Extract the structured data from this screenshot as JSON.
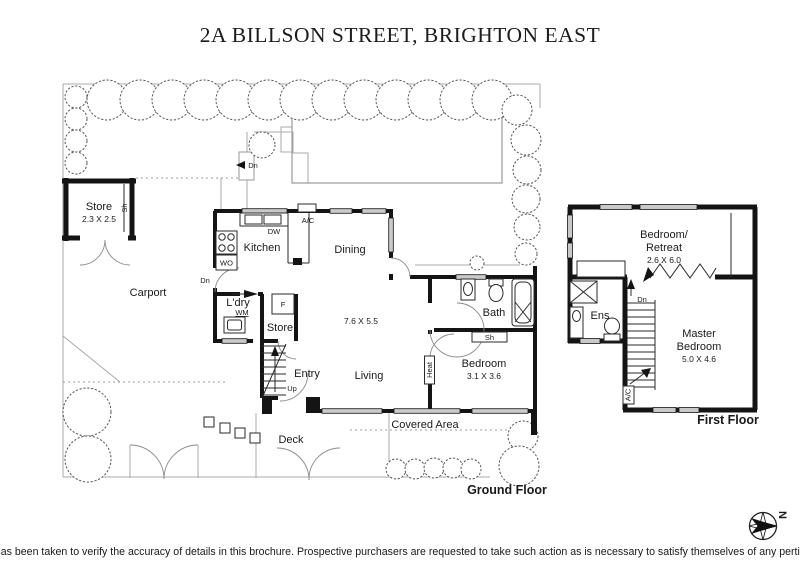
{
  "title": "2A BILLSON STREET, BRIGHTON EAST",
  "disclaimer": "Every care has been taken to verify the accuracy of details in this brochure. Prospective purchasers are requested to take such action as is necessary to satisfy themselves of any pertinent matters",
  "colors": {
    "wall": "#141414",
    "window_fill": "#c9c9c9",
    "landscape_line": "#a9a9a9",
    "text": "#1a1a1a"
  },
  "compass": {
    "north": "N"
  },
  "ground": {
    "floor_label": "Ground Floor",
    "rooms": {
      "store_outdoor": {
        "name": "Store",
        "dims": "2.3 X 2.5"
      },
      "carport": {
        "name": "Carport"
      },
      "kitchen": {
        "name": "Kitchen"
      },
      "dining": {
        "name": "Dining"
      },
      "laundry": {
        "name": "L'dry"
      },
      "store_inner": {
        "name": "Store"
      },
      "entry": {
        "name": "Entry"
      },
      "living": {
        "name": "Living",
        "dims": "7.6 X 5.5"
      },
      "bath": {
        "name": "Bath"
      },
      "bedroom": {
        "name": "Bedroom",
        "dims": "3.1 X 3.6"
      },
      "deck": {
        "name": "Deck"
      },
      "covered": {
        "name": "Covered Area"
      }
    },
    "annotations": {
      "dn_steps": "Dn",
      "dn_kitchen": "Dn",
      "up": "Up",
      "sh_store": "Sh",
      "sh_bath": "Sh",
      "dishwasher": "DW",
      "wall_oven": "WO",
      "washing_machine": "WM",
      "fridge": "F",
      "ac": "A/C",
      "heat": "Heat"
    }
  },
  "first": {
    "floor_label": "First Floor",
    "rooms": {
      "retreat": {
        "name_line1": "Bedroom/",
        "name_line2": "Retreat",
        "dims": "2.6 X 6.0"
      },
      "ens": {
        "name": "Ens"
      },
      "master": {
        "name_line1": "Master",
        "name_line2": "Bedroom",
        "dims": "5.0 X 4.6"
      }
    },
    "annotations": {
      "dn": "Dn",
      "ac": "A/C"
    }
  }
}
